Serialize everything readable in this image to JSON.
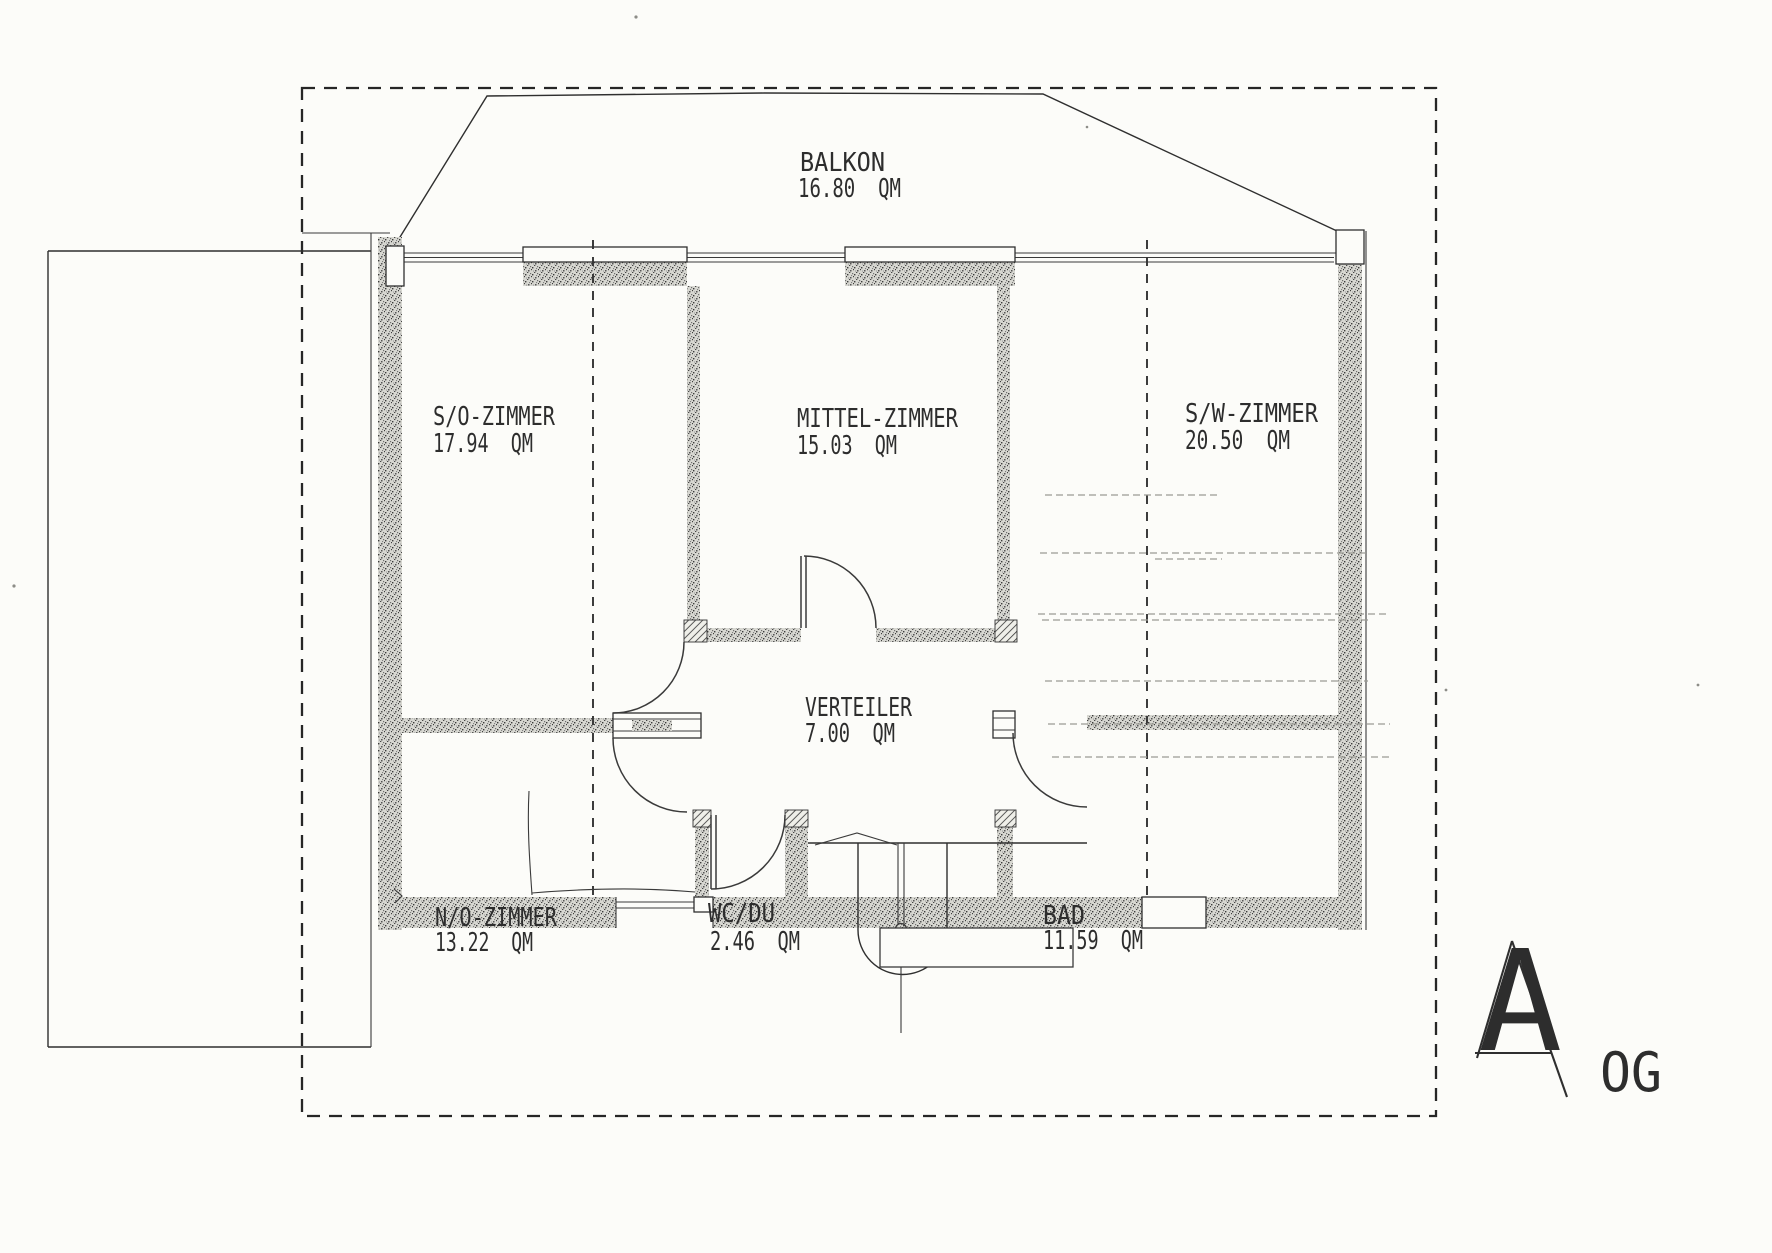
{
  "drawing": {
    "floor_label": "OG",
    "plan_letter": "A",
    "rooms": [
      {
        "name": "BALKON",
        "area": "16.80  QM"
      },
      {
        "name": "S/O-ZIMMER",
        "area": "17.94  QM"
      },
      {
        "name": "MITTEL-ZIMMER",
        "area": "15.03  QM"
      },
      {
        "name": "S/W-ZIMMER",
        "area": "20.50  QM"
      },
      {
        "name": "VERTEILER",
        "area": "7.00  QM"
      },
      {
        "name": "N/O-ZIMMER",
        "area": "13.22  QM"
      },
      {
        "name": "WC/DU",
        "area": "2.46  QM"
      },
      {
        "name": "BAD",
        "area": "11.59  QM"
      }
    ],
    "colors": {
      "paper": "#fcfcf9",
      "ink": "#2d2d2d"
    }
  }
}
